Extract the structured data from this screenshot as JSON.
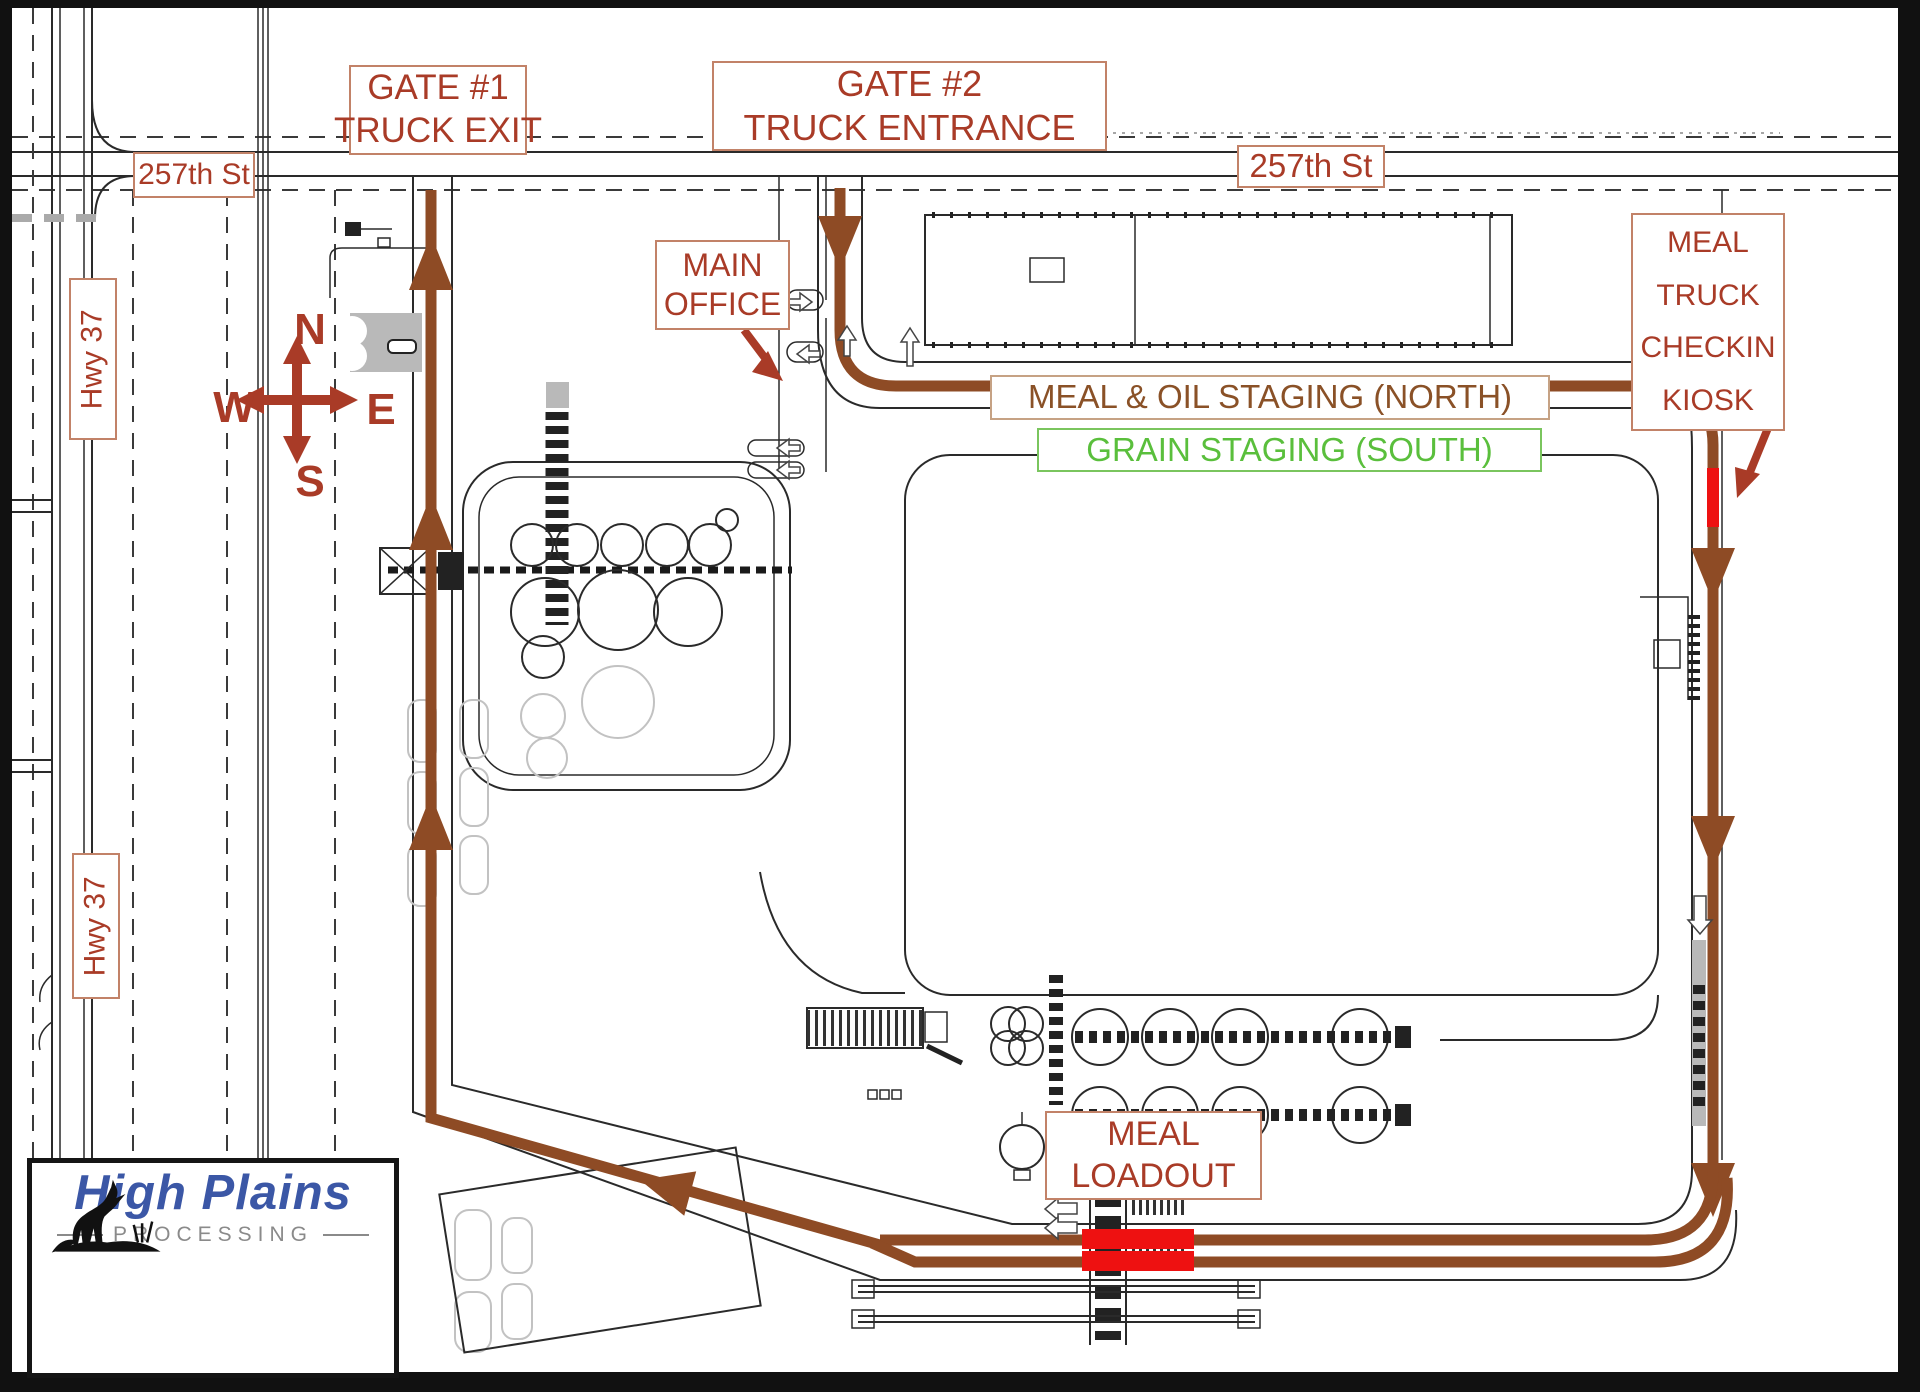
{
  "signs": {
    "gate1": {
      "lines": [
        "GATE #1",
        "TRUCK EXIT"
      ]
    },
    "gate2": {
      "lines": [
        "GATE #2",
        "TRUCK ENTRANCE"
      ]
    },
    "street_left": "257th St",
    "street_right": "257th St",
    "hwy_upper": "Hwy 37",
    "hwy_lower": "Hwy 37",
    "main_office": {
      "lines": [
        "MAIN",
        "OFFICE"
      ]
    },
    "kiosk": {
      "lines": [
        "MEAL",
        "TRUCK",
        "CHECKIN",
        "KIOSK"
      ]
    },
    "staging_north": "MEAL & OIL STAGING (NORTH)",
    "staging_south": "GRAIN STAGING (SOUTH)",
    "meal_loadout": {
      "lines": [
        "MEAL",
        "LOADOUT"
      ]
    }
  },
  "compass": {
    "north": "N",
    "south": "S",
    "east": "E",
    "west": "W"
  },
  "logo": {
    "name": "High Plains",
    "subtitle": "PROCESSING"
  },
  "colors": {
    "route_brown": "#8e4b25",
    "label_red": "#a93b27",
    "staging_brown": "#8a5127",
    "staging_green": "#5abf3c",
    "highlight_red": "#ee1111",
    "logo_blue": "#3b57a6",
    "logo_grey": "#8a8a8a",
    "linework": "#2a2a2a"
  }
}
